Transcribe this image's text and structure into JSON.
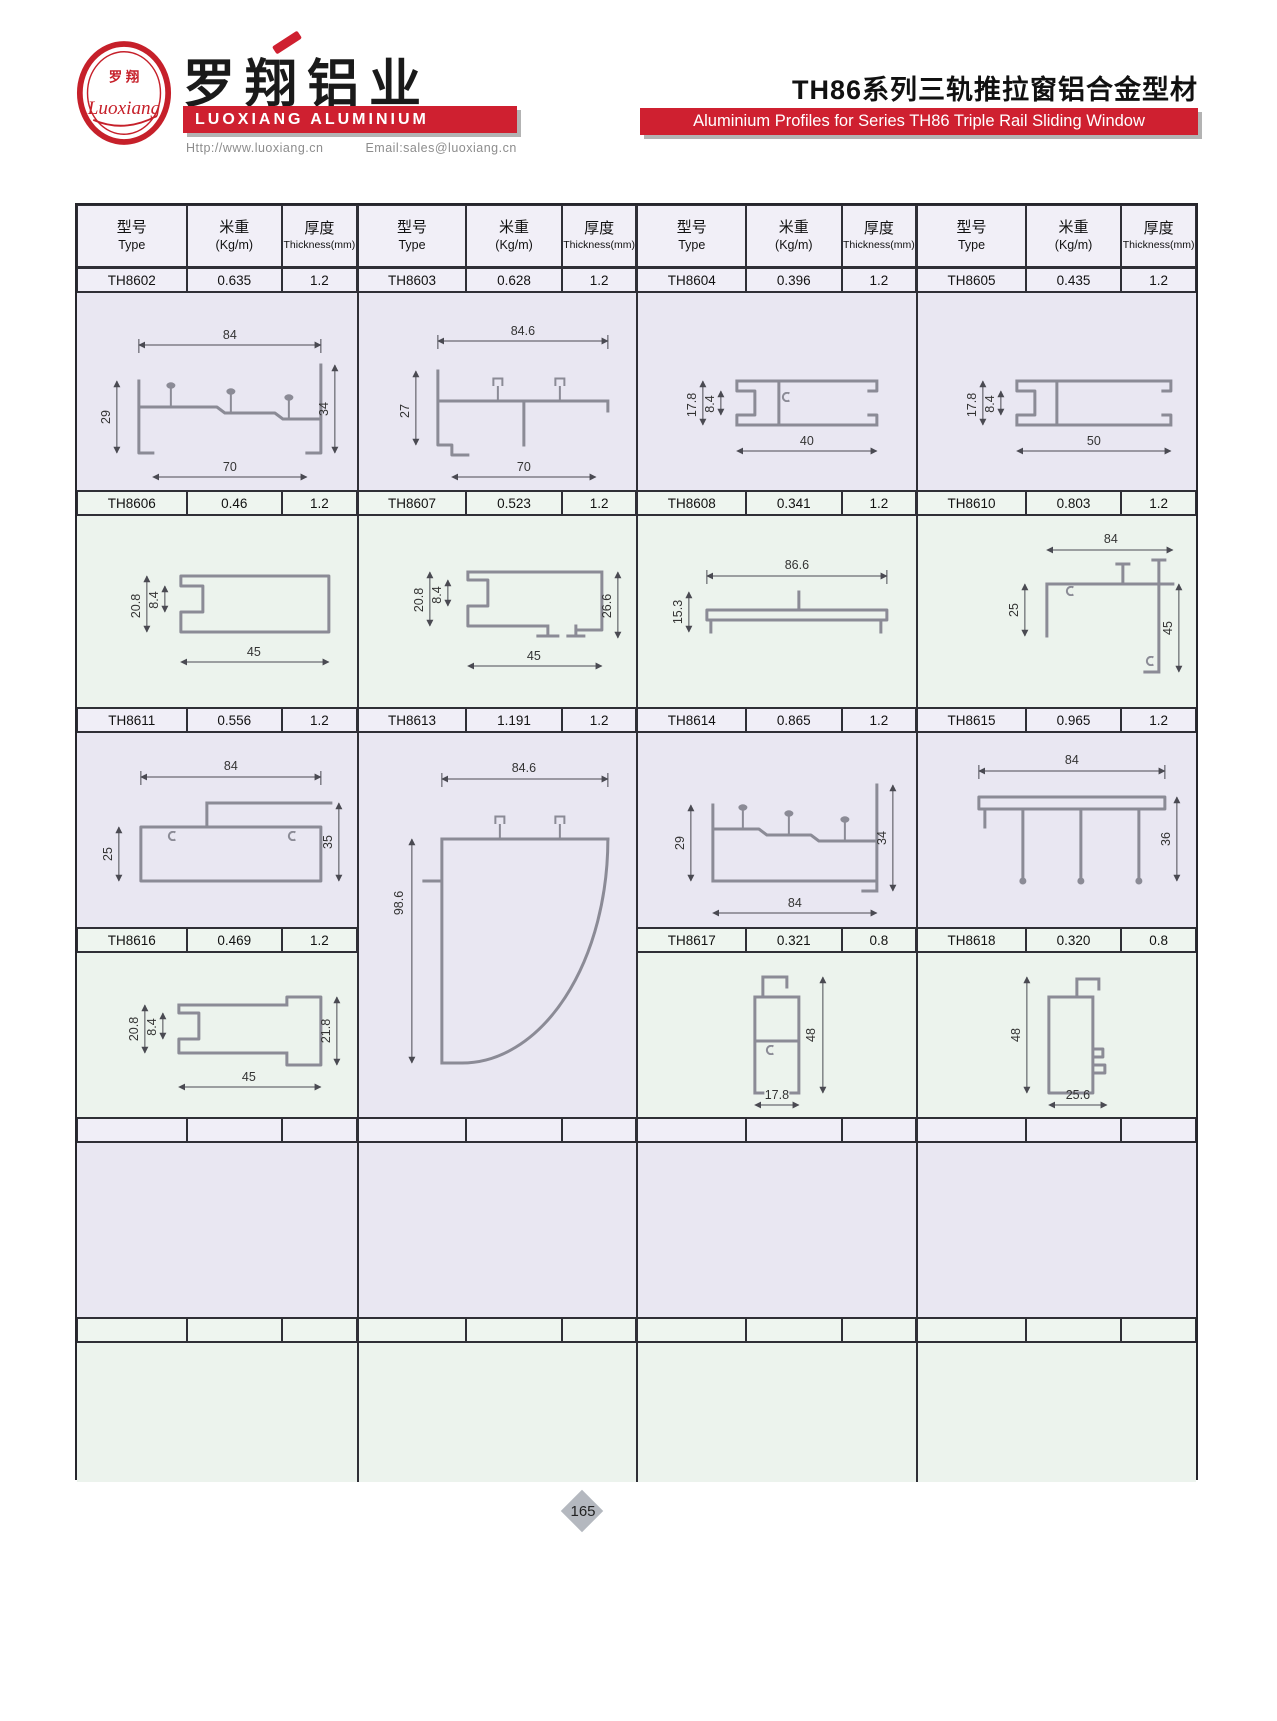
{
  "header": {
    "logo_cn": "罗 翔",
    "logo_script": "Luoxiang",
    "company_cn": "罗翔铝业",
    "company_en": "LUOXIANG ALUMINIUM",
    "website": "Http://www.luoxiang.cn",
    "email": "Email:sales@luoxiang.cn",
    "series_cn": "TH86系列三轨推拉窗铝合金型材",
    "series_en": "Aluminium Profiles for Series TH86 Triple Rail Sliding Window"
  },
  "table": {
    "head": {
      "type_cn": "型号",
      "type_en": "Type",
      "kgm_cn": "米重",
      "kgm_en": "(Kg/m)",
      "thk_cn": "厚度",
      "thk_en": "Thickness(mm)"
    },
    "rows": [
      [
        {
          "type": "TH8602",
          "kgm": "0.635",
          "thk": "1.2"
        },
        {
          "type": "TH8603",
          "kgm": "0.628",
          "thk": "1.2"
        },
        {
          "type": "TH8604",
          "kgm": "0.396",
          "thk": "1.2"
        },
        {
          "type": "TH8605",
          "kgm": "0.435",
          "thk": "1.2"
        }
      ],
      [
        {
          "type": "TH8606",
          "kgm": "0.46",
          "thk": "1.2"
        },
        {
          "type": "TH8607",
          "kgm": "0.523",
          "thk": "1.2"
        },
        {
          "type": "TH8608",
          "kgm": "0.341",
          "thk": "1.2"
        },
        {
          "type": "TH8610",
          "kgm": "0.803",
          "thk": "1.2"
        }
      ],
      [
        {
          "type": "TH8611",
          "kgm": "0.556",
          "thk": "1.2"
        },
        {
          "type": "TH8613",
          "kgm": "1.191",
          "thk": "1.2"
        },
        {
          "type": "TH8614",
          "kgm": "0.865",
          "thk": "1.2"
        },
        {
          "type": "TH8615",
          "kgm": "0.965",
          "thk": "1.2"
        }
      ],
      [
        {
          "type": "TH8616",
          "kgm": "0.469",
          "thk": "1.2"
        },
        {
          "type": "TH8617",
          "kgm": "0.321",
          "thk": "0.8"
        },
        {
          "type": "TH8618",
          "kgm": "0.320",
          "thk": "0.8"
        }
      ]
    ]
  },
  "drw": {
    "TH8602": {
      "top": "84",
      "left": "29",
      "right": "34",
      "bottom": "70"
    },
    "TH8603": {
      "top": "84.6",
      "left": "27",
      "bottom": "70"
    },
    "TH8604": {
      "h1": "17.8",
      "h2": "8.4",
      "bottom": "40"
    },
    "TH8605": {
      "h1": "17.8",
      "h2": "8.4",
      "bottom": "50"
    },
    "TH8606": {
      "h1": "20.8",
      "h2": "8.4",
      "bottom": "45"
    },
    "TH8607": {
      "h1": "20.8",
      "h2": "8.4",
      "right": "26.6",
      "bottom": "45"
    },
    "TH8608": {
      "top": "86.6",
      "left": "15.3"
    },
    "TH8610": {
      "top": "84",
      "left": "25",
      "right": "45"
    },
    "TH8611": {
      "top": "84",
      "left": "25",
      "right": "35"
    },
    "TH8613": {
      "top": "84.6",
      "left": "98.6"
    },
    "TH8614": {
      "left": "29",
      "right": "34",
      "bottom": "84"
    },
    "TH8615": {
      "top": "84",
      "right": "36"
    },
    "TH8616": {
      "h1": "20.8",
      "h2": "8.4",
      "right": "21.8",
      "bottom": "45"
    },
    "TH8617": {
      "right": "48",
      "bottom": "17.8"
    },
    "TH8618": {
      "left": "48",
      "bottom": "25.6"
    }
  },
  "page_number": "165",
  "colors": {
    "brand_red": "#cf2030",
    "lavender_band": "#e9e7f2",
    "green_band": "#ecf3ed"
  }
}
